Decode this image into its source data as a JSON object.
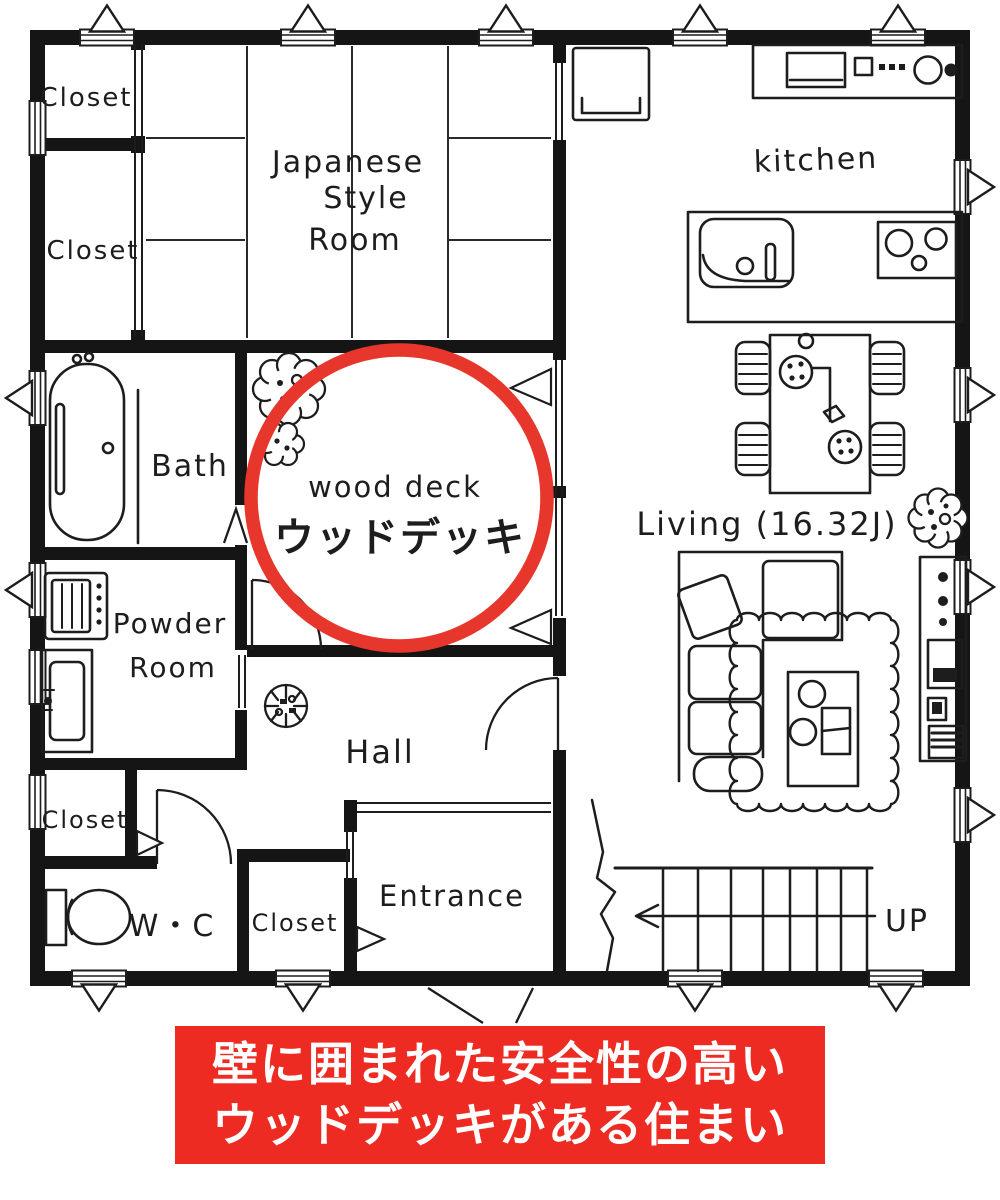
{
  "labels": {
    "closet_nw_top": "Closet",
    "closet_nw_bottom": "Closet",
    "japanese_room_line1": "Japanese",
    "japanese_room_line2": "Style",
    "japanese_room_line3": "Room",
    "kitchen": "kitchen",
    "bath": "Bath",
    "wood_deck_en": "wood deck",
    "wood_deck_ja": "ウッドデッキ",
    "powder_room_line1": "Powder",
    "powder_room_line2": "Room",
    "hall": "Hall",
    "living": "Living (16.32J)",
    "closet_west": "Closet",
    "wc": "W・C",
    "closet_entrance": "Closet",
    "entrance": "Entrance",
    "stairs_up": "UP"
  },
  "banner": {
    "line1": "壁に囲まれた安全性の高い",
    "line2": "ウッドデッキがある住まい"
  },
  "colors": {
    "highlight_red": "#e7362c",
    "banner_red": "#ee2b22",
    "banner_text": "#ffffff",
    "ink": "#1d1d1d"
  }
}
